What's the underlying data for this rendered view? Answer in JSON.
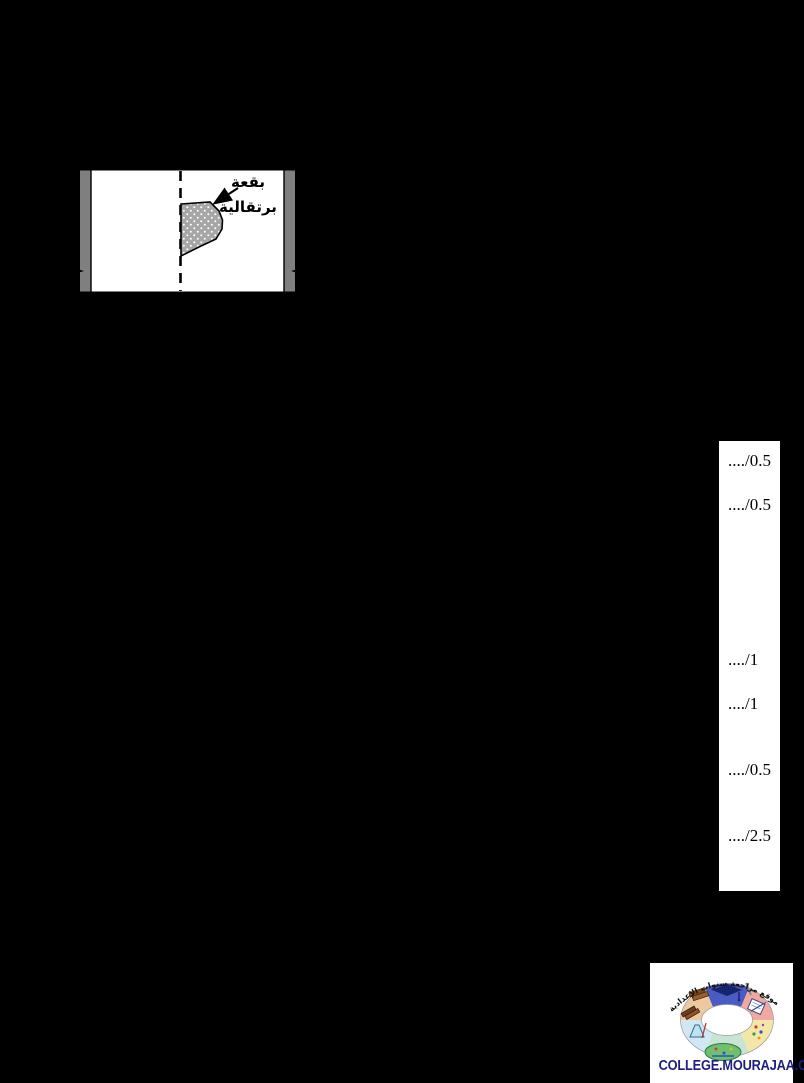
{
  "page": {
    "background_color": "#000000"
  },
  "diagram": {
    "spot_label": {
      "line1": "بقعة",
      "line2": "برتقالية"
    },
    "colors": {
      "paper": "#ffffff",
      "edge_bar_gray": "#7f7f7f",
      "spot_gray": "#a6a6a6",
      "outline": "#000000"
    }
  },
  "score_column": {
    "items": [
      {
        "label": "..../0.5"
      },
      {
        "label": "..../0.5"
      },
      {
        "label": "..../1"
      },
      {
        "label": "..../1"
      },
      {
        "label": "..../0.5"
      },
      {
        "label": "..../2.5"
      }
    ]
  },
  "logo": {
    "arc_text": "موقع مراجعة سنوات الإعدادية",
    "site_name": "COLLEGE.MOURAJAA.COM",
    "brand_color": "#1d1d7e",
    "ring_colors": [
      "#4a5bc4",
      "#f0a8a0",
      "#f5e6a8",
      "#c9e4d4",
      "#cfe8f4",
      "#ecc9a0"
    ]
  }
}
